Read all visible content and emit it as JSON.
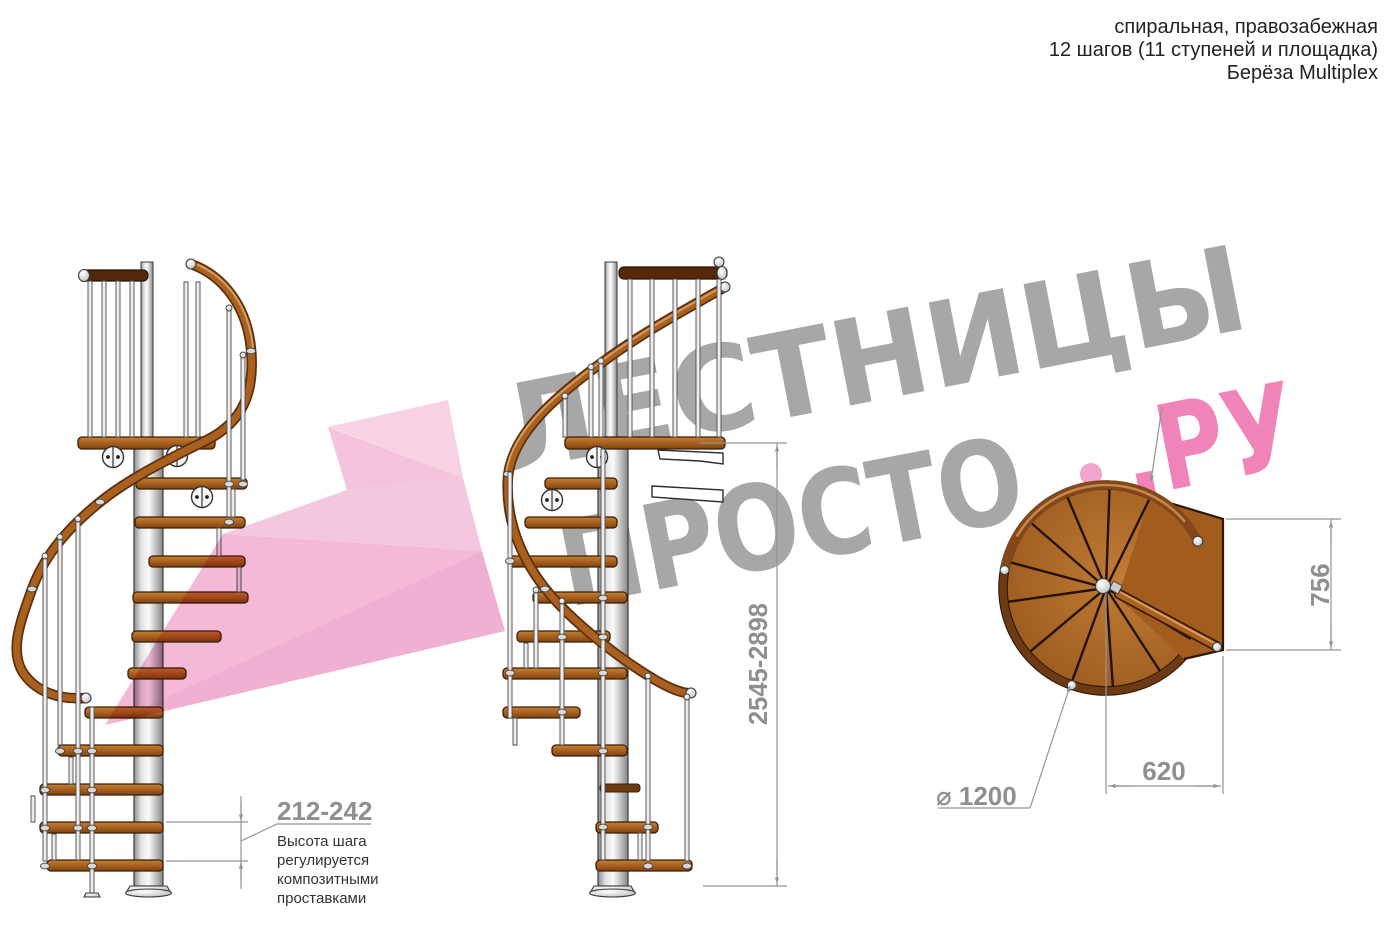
{
  "header": {
    "line1": "спиральная, правозабежная",
    "line2": "12 шагов (11 ступеней и площадка)",
    "line3": "Берёза Multiplex"
  },
  "watermark": {
    "word1": "ЛЕСТНИЦЫ",
    "word2": "ПРОСТО",
    "word2_suffix": ".РУ"
  },
  "annotations": {
    "step_height": {
      "value": "212-242",
      "lines": [
        "Высота шага",
        "регулируется",
        "композитными",
        "проставками"
      ]
    },
    "total_height": "2545-2898",
    "landing_depth": "756",
    "landing_width": "620",
    "diameter": "⌀ 1200"
  },
  "colors": {
    "watermark_gray": "#a7a7a7",
    "watermark_pink": "#f083b8",
    "dimension_gray": "#8f8f8f",
    "wood_brown": "#a9611f",
    "steel_silver": "#d9d9d9",
    "highlight_pink": "#f2b3d5"
  }
}
